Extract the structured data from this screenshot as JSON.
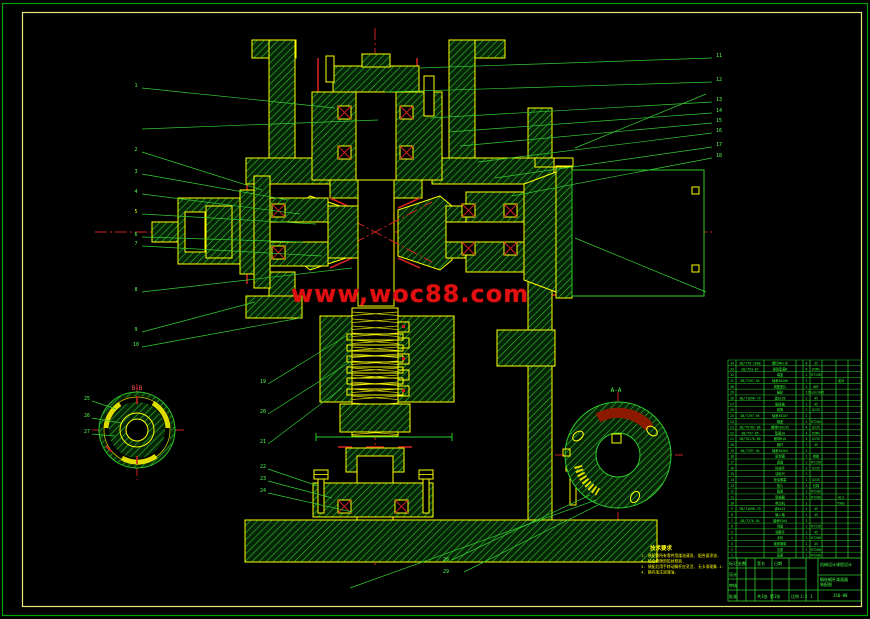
{
  "watermark": {
    "text": "www,woc88.com",
    "color": "#e01010"
  },
  "view_labels": {
    "left_section": "B-B",
    "right_section": "A-A"
  },
  "notes": {
    "title": "技术要求",
    "lines": [
      "1. 装配前所有零件用煤油清洗, 配合面涂油.",
      "2. 啮合侧隙用铅丝检验.",
      "3. 装配后用手转动蜗杆应灵活, 无卡滞现象-1.",
      "4. 箱内加注润滑油."
    ]
  },
  "callouts": {
    "left": [
      "1",
      "2",
      "3",
      "4",
      "5",
      "6",
      "7",
      "8",
      "9",
      "10"
    ],
    "right": [
      "11",
      "12",
      "13",
      "14",
      "15",
      "16",
      "17",
      "18"
    ],
    "bottom_left": [
      "19",
      "20",
      "21",
      "22",
      "23",
      "24"
    ],
    "left_view": [
      "25",
      "26",
      "27"
    ],
    "right_view": [
      "28",
      "29"
    ]
  },
  "bom": {
    "rows": [
      [
        "34",
        "GB/T70-2000",
        "螺钉M6x16",
        "6",
        "35",
        ""
      ],
      [
        "33",
        "GB/T93-87",
        "弹簧垫圈6",
        "6",
        "65Mn",
        ""
      ],
      [
        "32",
        "",
        "端盖",
        "1",
        "HT150",
        ""
      ],
      [
        "31",
        "GB/T297-94",
        "轴承30206",
        "2",
        "",
        "成对"
      ],
      [
        "30",
        "",
        "调整垫片",
        "2",
        "08F",
        ""
      ],
      [
        "29",
        "",
        "蜗轮",
        "1",
        "ZCuSn10P1",
        ""
      ],
      [
        "28",
        "GB/T1096-79",
        "键8x28",
        "1",
        "45",
        ""
      ],
      [
        "27",
        "",
        "蜗轮轴",
        "1",
        "45",
        ""
      ],
      [
        "26",
        "",
        "套筒",
        "2",
        "Q235",
        ""
      ],
      [
        "25",
        "GB/T297-94",
        "轴承30207",
        "2",
        "",
        ""
      ],
      [
        "24",
        "",
        "箱座",
        "1",
        "HT200",
        ""
      ],
      [
        "23",
        "GB/T5782-86",
        "螺栓M10x35",
        "4",
        "Q235",
        ""
      ],
      [
        "22",
        "GB/T97-85",
        "垫圈10",
        "4",
        "65Mn",
        ""
      ],
      [
        "21",
        "GB/T6170-86",
        "螺母M10",
        "4",
        "Q235",
        ""
      ],
      [
        "20",
        "",
        "蜗杆",
        "1",
        "45",
        ""
      ],
      [
        "19",
        "GB/T297-94",
        "轴承30204",
        "2",
        "",
        ""
      ],
      [
        "18",
        "",
        "密封圈",
        "2",
        "橡胶",
        ""
      ],
      [
        "17",
        "",
        "透盖",
        "1",
        "HT150",
        ""
      ],
      [
        "16",
        "",
        "挡油环",
        "2",
        "Q235",
        ""
      ],
      [
        "15",
        "",
        "油标尺",
        "1",
        "",
        ""
      ],
      [
        "14",
        "",
        "放油螺塞",
        "1",
        "Q235",
        ""
      ],
      [
        "13",
        "",
        "垫片",
        "1",
        "石棉",
        ""
      ],
      [
        "12",
        "",
        "箱盖",
        "1",
        "HT200",
        ""
      ],
      [
        "11",
        "",
        "联轴器",
        "1",
        "HT200",
        "HL3"
      ],
      [
        "10",
        "",
        "电动机",
        "1",
        "",
        "Y90S"
      ],
      [
        "9",
        "GB/T1096-79",
        "键6x22",
        "1",
        "45",
        ""
      ],
      [
        "8",
        "",
        "输入轴",
        "1",
        "45",
        ""
      ],
      [
        "7",
        "GB/T276-94",
        "轴承6204",
        "2",
        "",
        ""
      ],
      [
        "6",
        "",
        "闷盖",
        "1",
        "HT150",
        ""
      ],
      [
        "5",
        "",
        "调整环",
        "1",
        "45",
        ""
      ],
      [
        "4",
        "",
        "手轮",
        "1",
        "HT200",
        ""
      ],
      [
        "3",
        "",
        "锁紧螺母",
        "2",
        "45",
        ""
      ],
      [
        "2",
        "",
        "支座",
        "1",
        "HT200",
        ""
      ],
      [
        "1",
        "",
        "底座",
        "1",
        "HT200",
        ""
      ]
    ]
  },
  "title_block": {
    "mark": "标记",
    "count": "处数",
    "sign": "签名",
    "date": "日期",
    "designer": "设计",
    "auditor": "审核",
    "approver": "批准",
    "scale_label": "比例",
    "scale": "1:2",
    "company": "机械设计课程设计",
    "title_line1": "蜗轮蜗杆减速器",
    "title_line2": "装配图",
    "drawing_no": "JSQ-00",
    "sheet": "共1张 第1张",
    "qty": "1"
  }
}
